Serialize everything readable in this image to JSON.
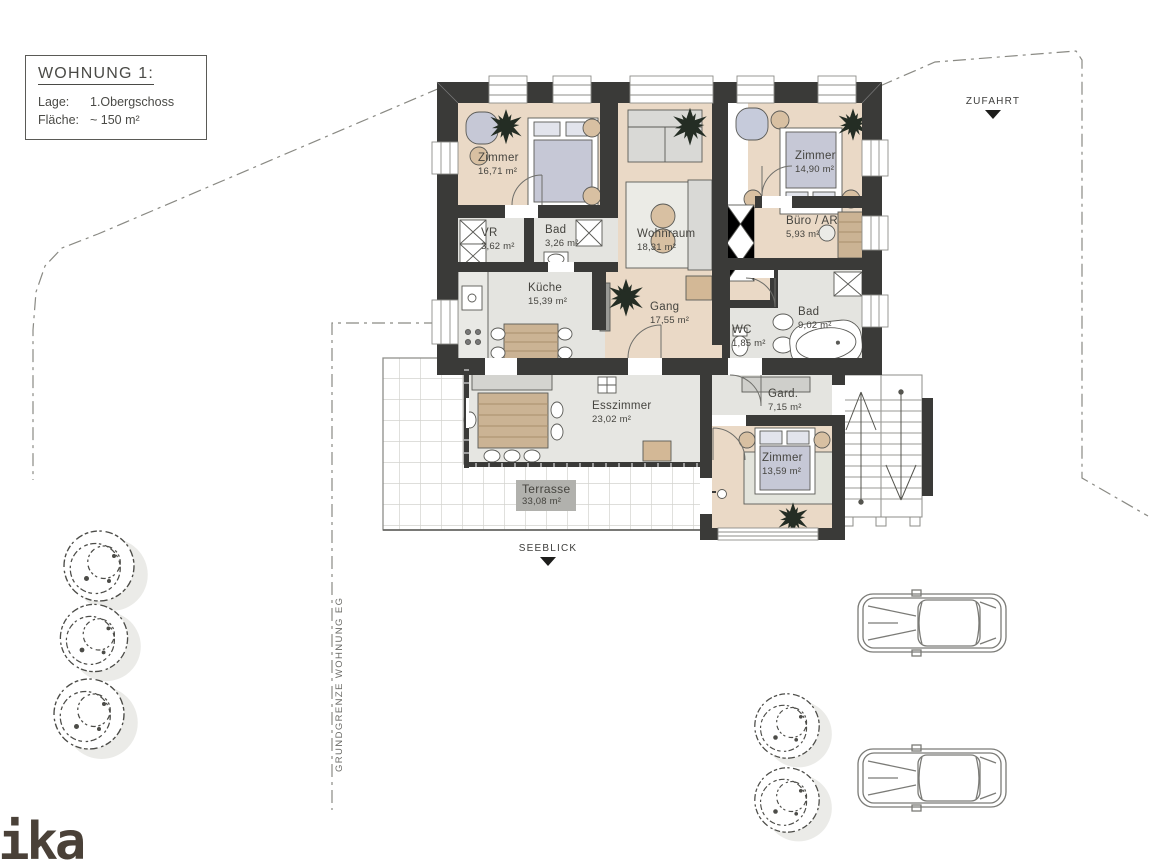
{
  "info_box": {
    "title": "WOHNUNG 1:",
    "rows": [
      {
        "label": "Lage:",
        "value": "1.Obergschoss"
      },
      {
        "label": "Fläche:",
        "value": "~ 150 m²"
      }
    ]
  },
  "rooms": [
    {
      "name": "Zimmer",
      "area": "16,71 m²"
    },
    {
      "name": "VR",
      "area": "3,62 m²"
    },
    {
      "name": "Bad",
      "area": "3,26 m²"
    },
    {
      "name": "Wohnraum",
      "area": "18,31 m²"
    },
    {
      "name": "Zimmer",
      "area": "14,90 m²"
    },
    {
      "name": "Büro / AR",
      "area": "5,93 m²"
    },
    {
      "name": "Küche",
      "area": "15,39 m²"
    },
    {
      "name": "Gang",
      "area": "17,55 m²"
    },
    {
      "name": "WC",
      "area": "1,85 m²"
    },
    {
      "name": "Bad",
      "area": "9,02 m²"
    },
    {
      "name": "Esszimmer",
      "area": "23,02 m²"
    },
    {
      "name": "Gard.",
      "area": "7,15 m²"
    },
    {
      "name": "Zimmer",
      "area": "13,59 m²"
    },
    {
      "name": "Terrasse",
      "area": "33,08 m²"
    }
  ],
  "annotations": {
    "zufahrt": "ZUFAHRT",
    "seeblick": "SEEBLICK",
    "boundary_note": "GRUNDGRENZE WOHNUNG EG"
  },
  "logo_text": "mika",
  "colors": {
    "wall": "#3a3a38",
    "floor_beige": "#ead9c6",
    "floor_gray": "#e4e4e0",
    "wood": "#cbb394",
    "bed": "#c6c8d6",
    "tan": "#d8c0a2",
    "terrace_label_bg": "#b1b1ad"
  }
}
